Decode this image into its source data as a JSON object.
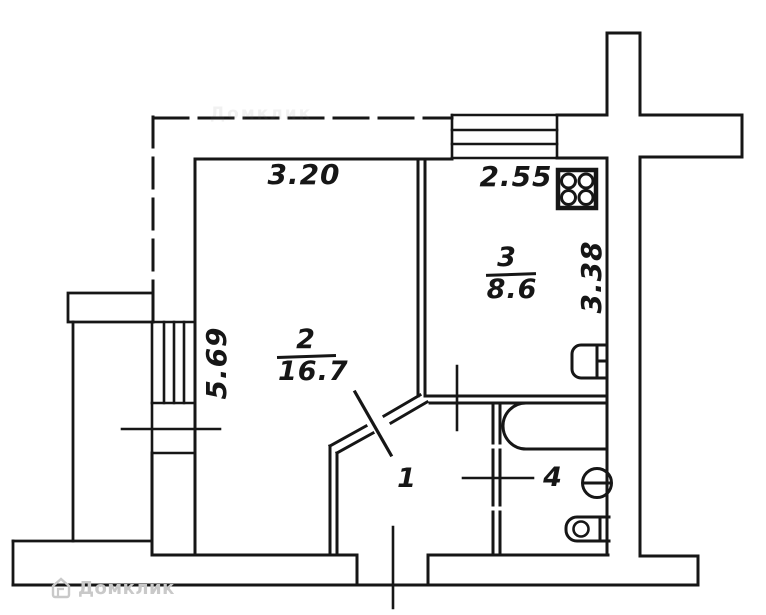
{
  "watermark": {
    "brand": "Домклик"
  },
  "dimensions": {
    "room2_width_m": "3.20",
    "room2_depth_m": "5.69",
    "room3_width_m": "2.55",
    "room3_depth_m": "3.38"
  },
  "rooms": [
    {
      "number": "1",
      "area": ""
    },
    {
      "number": "2",
      "area": "16.7"
    },
    {
      "number": "3",
      "area": "8.6"
    },
    {
      "number": "4",
      "area": ""
    }
  ],
  "fixtures": {
    "kitchen_stove": "stove-4-burner-icon",
    "kitchen_sink": "kitchen-sink-icon",
    "bathtub": "bathtub-icon",
    "toilet": "toilet-icon",
    "wash_basin": "wash-basin-icon"
  },
  "colors": {
    "line": "#161616",
    "watermark": "#c9c9c9",
    "background": "#ffffff"
  }
}
